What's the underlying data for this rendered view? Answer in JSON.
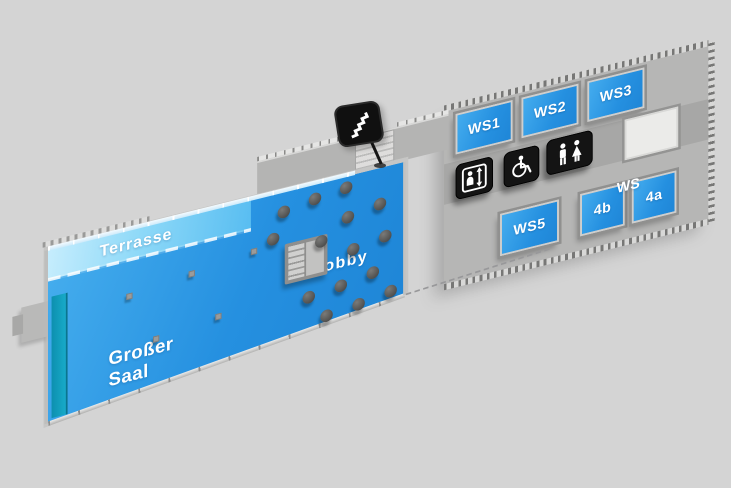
{
  "map": {
    "background_color": "#d4d4d4",
    "colors": {
      "room_fill": "#2b94e2",
      "terrace_fill_light": "#c6edfd",
      "terrace_fill_dark": "#58bdf1",
      "stage_fill": "#119cba",
      "platform_gray": "#b6b6b5",
      "corridor_gray": "#a7a7a6",
      "sign_black": "#141414",
      "label_color": "#ffffff"
    },
    "rooms": {
      "terrace": {
        "label": "Terrasse"
      },
      "great_hall": {
        "label": "Großer Saal"
      },
      "lobby": {
        "label": "Lobby"
      },
      "ws1": {
        "label": "WS1"
      },
      "ws2": {
        "label": "WS2"
      },
      "ws3": {
        "label": "WS3"
      },
      "ws5": {
        "label": "WS5"
      },
      "ws4_prefix": {
        "label": "WS"
      },
      "ws4b": {
        "label": "4b"
      },
      "ws4a": {
        "label": "4a"
      }
    },
    "markers": {
      "stairs": {
        "icon": "stairs-icon"
      },
      "elevator": {
        "icon": "elevator-icon"
      },
      "accessible_wc": {
        "icon": "wheelchair-icon"
      },
      "wc": {
        "icon": "wc-icon"
      }
    }
  }
}
